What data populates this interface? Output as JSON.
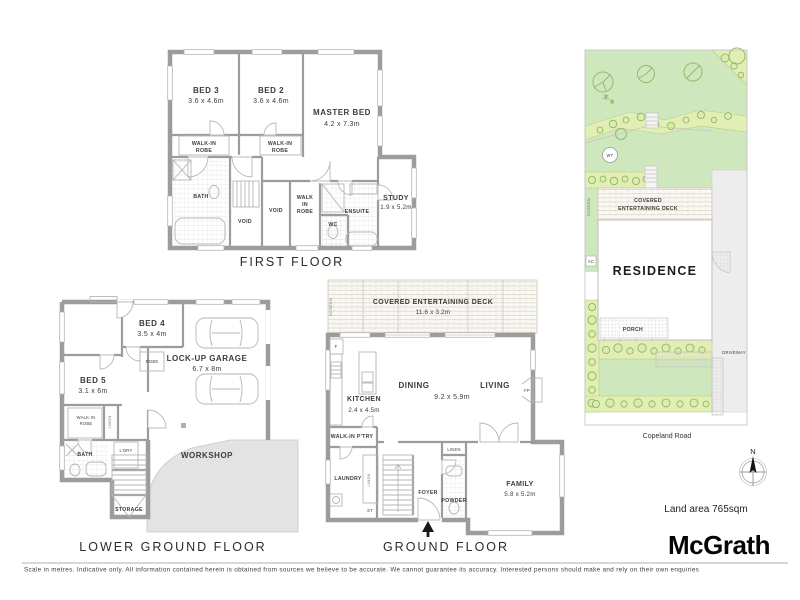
{
  "first_floor": {
    "label": "FIRST FLOOR",
    "bed3": [
      "BED 3",
      "3.6 x 4.6m"
    ],
    "bed2": [
      "BED 2",
      "3.6 x 4.6m"
    ],
    "master": [
      "MASTER BED",
      "4.2 x 7.3m"
    ],
    "walk_in_robe": [
      "WALK-IN",
      "ROBE"
    ],
    "wir3": [
      "WALK",
      "IN",
      "ROBE"
    ],
    "bath": "BATH",
    "void": "VOID",
    "ensuite": "ENSUITE",
    "wc": "WC",
    "study": [
      "STUDY",
      "1.9 x 5.2m"
    ]
  },
  "lower_ground": {
    "label": "LOWER GROUND FLOOR",
    "bed4": [
      "BED 4",
      "3.5 x 4m"
    ],
    "bed5": [
      "BED 5",
      "3.1 x 6m"
    ],
    "garage": [
      "LOCK-UP GARAGE",
      "6.7 x 8m"
    ],
    "workshop": "WORKSHOP",
    "robe": "ROBE",
    "walk_in_robe": [
      "WALK-IN",
      "ROBE"
    ],
    "linen": "LINEN",
    "bath": "BATH",
    "ldry": "L'DRY",
    "storage": "STORAGE"
  },
  "ground_floor": {
    "label": "GROUND FLOOR",
    "deck": [
      "COVERED ENTERTAINING DECK",
      "11.6 x 3.2m"
    ],
    "kitchen": [
      "KITCHEN",
      "2.4 x 4.5m"
    ],
    "dining": "DINING",
    "living": "LIVING",
    "area_dims": "9.2 x 5.9m",
    "family": [
      "FAMILY",
      "5.8 x 5.2m"
    ],
    "pantry": "WALK-IN P'TRY",
    "laundry": "LAUNDRY",
    "foyer": "FOYER",
    "powder": "POWDER",
    "linen": "LINEN",
    "st": "ST",
    "fp": "FP",
    "fridge": "F",
    "screen": "SCREEN"
  },
  "site": {
    "residence": "RESIDENCE",
    "deck_line1": "COVERED",
    "deck_line2": "ENTERTAINING DECK",
    "porch": "PORCH",
    "driveway": "DRIVEWAY",
    "screen": "SCREEN",
    "ac": "AC",
    "water_tank": "WT",
    "road": "Copeland Road",
    "north": "N",
    "land_area": "Land area 765sqm"
  },
  "branding": {
    "logo": "McGrath",
    "disclaimer": "Scale in metres. Indicative only. All information contained herein is obtained from sources we believe to be accurate. We cannot guarantee its accuracy. Interested persons should make and rely on their own enquiries"
  },
  "colors": {
    "wall": "#9c9c9c",
    "lawn": "#cfe7bd",
    "garden_bed": "#e3eeb4",
    "bush": "#85b35c",
    "driveway": "#ededed"
  }
}
